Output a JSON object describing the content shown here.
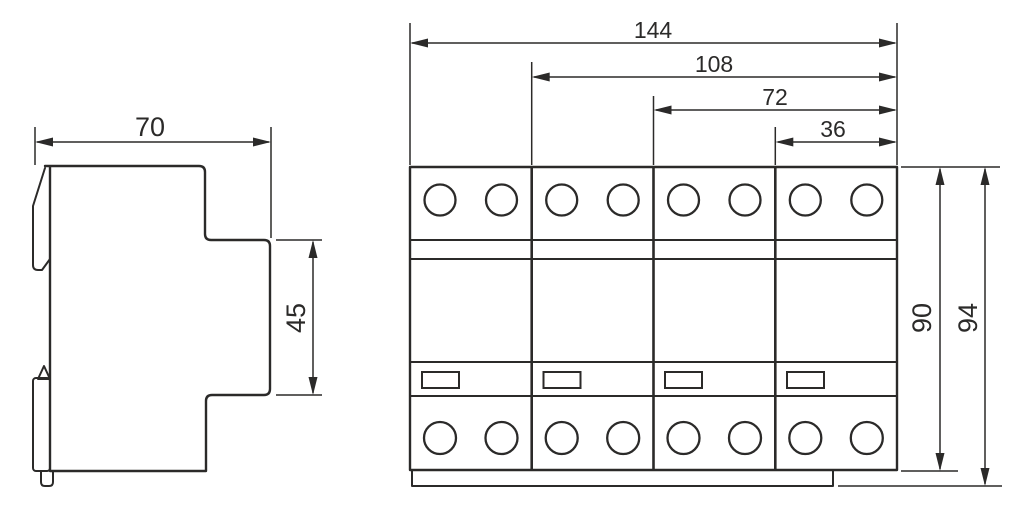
{
  "drawing": {
    "background_color": "#ffffff",
    "line_color": "#2b2a29",
    "side_view": {
      "dims": {
        "width": "70",
        "mount_depth": "45"
      }
    },
    "front_view": {
      "module_count": 4,
      "terminal_screws_top": 8,
      "terminal_screws_bottom": 8,
      "indicator_windows": 4,
      "dims": {
        "total_width": "144",
        "three_modules_width": "108",
        "two_modules_width": "72",
        "one_module_width": "36",
        "body_height": "90",
        "overall_height": "94"
      }
    }
  }
}
